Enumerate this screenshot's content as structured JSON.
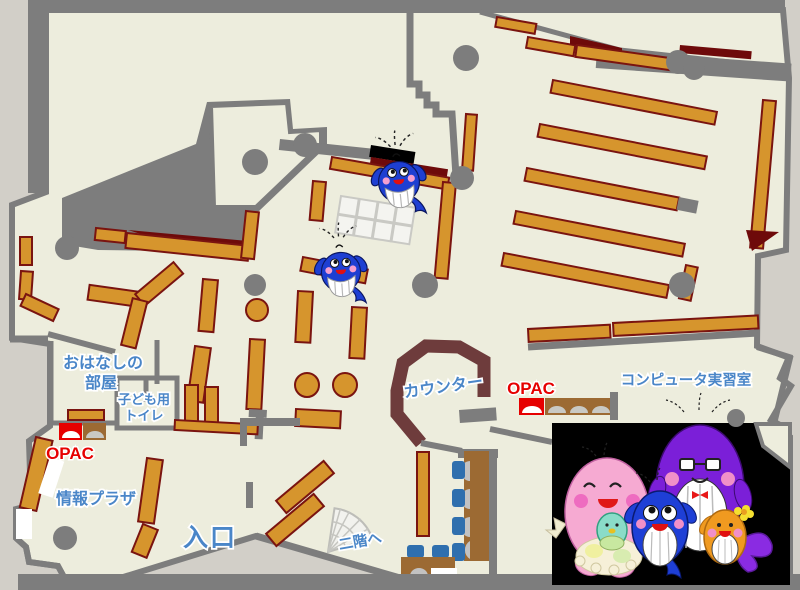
{
  "labels": {
    "story_room": {
      "line1": "おはなしの",
      "line2": "部屋"
    },
    "kids_toilet": {
      "line1": "子ども用",
      "line2": "トイレ"
    },
    "opac_left": "OPAC",
    "opac_center": "OPAC",
    "info_plaza": "情報プラザ",
    "entrance": "入口",
    "counter": "カウンター",
    "computer_room": "コンピュータ実習室",
    "to_second_floor": "二階へ"
  },
  "colors": {
    "background": "#d2cfc8",
    "floor": "#ededdd",
    "wall_gray": "#7d7d7d",
    "shelf_orange": "#d6952d",
    "shelf_border": "#7a1410",
    "dark_red": "#6e0a0a",
    "counter_brown": "#6e3c3c",
    "desk_brown": "#9c6a33",
    "chair_blue": "#2f6fae",
    "label_blue": "#4a86c8",
    "opac_red": "#e60000",
    "photo_background": "#000000",
    "mascot_blue": "#1e3fd2",
    "mascot_pink": "#f5a8d0",
    "mascot_purple": "#7b1fd8",
    "mascot_orange": "#f09a20"
  },
  "icons": {
    "map_mascots": [
      "whale-mascot-icon",
      "whale-mascot-icon"
    ],
    "family_photo_characters": [
      "pink-mother-whale-icon",
      "purple-father-whale-icon",
      "blue-child-whale-icon",
      "orange-child-whale-icon"
    ],
    "opac_terminals_left_count": 2,
    "opac_terminals_center_count": 4,
    "stairs": "stairs-fan-icon"
  }
}
